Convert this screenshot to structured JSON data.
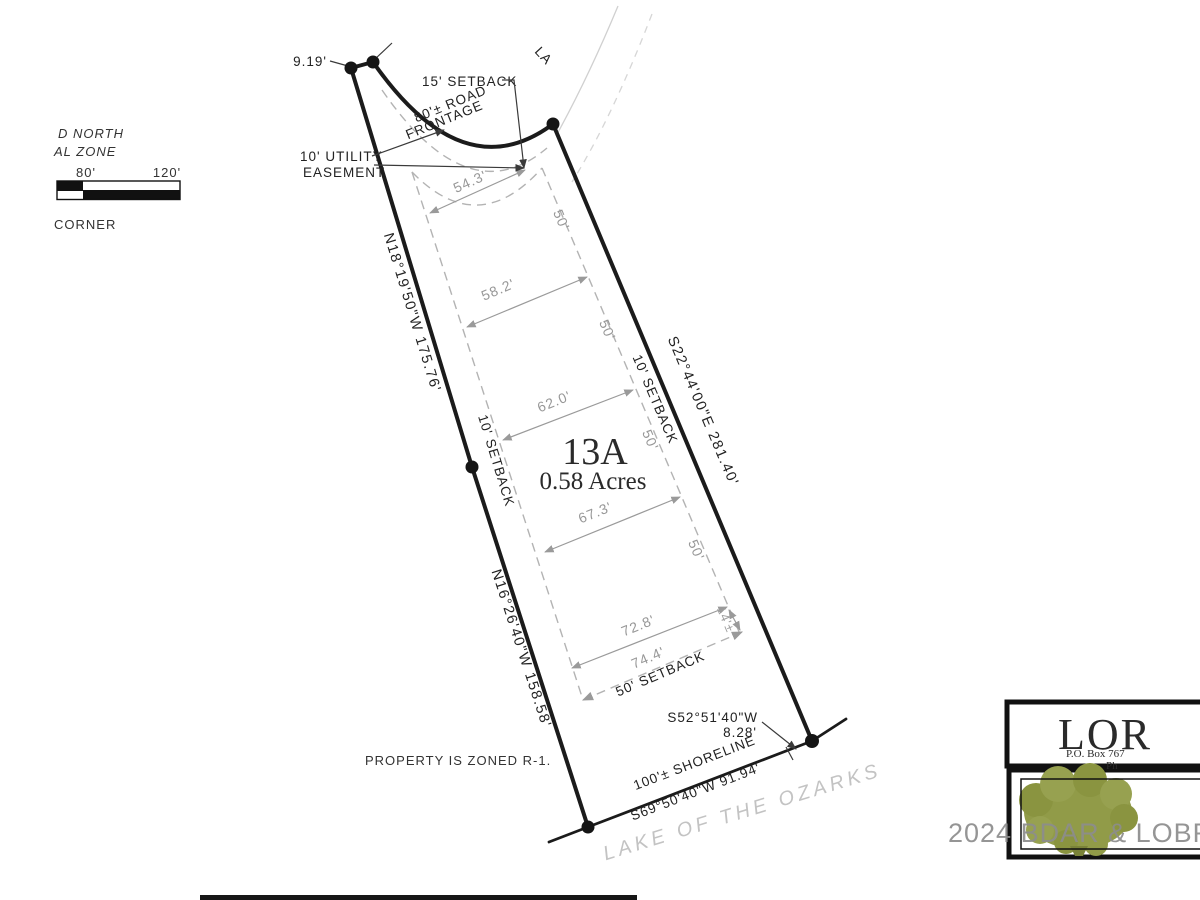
{
  "legend": {
    "north": "D NORTH",
    "zone": "AL ZONE",
    "scale_mid": "80'",
    "scale_end": "120'",
    "corner": "CORNER"
  },
  "top": {
    "offset_dim": "9.19'",
    "setback15": "15' SETBACK",
    "frontage1": "80'± ROAD",
    "frontage2": "FRONTAGE",
    "utility1": "10' UTILITY",
    "utility2": "EASEMENT",
    "road_name": "LA"
  },
  "boundaries": {
    "left_upper": "N18°19'50\"W  175.76'",
    "left_lower": "N16°26'40\"W  158.58'",
    "right": "S22°44'00\"E  281.40'",
    "setback_left": "10' SETBACK",
    "setback_right": "10' SETBACK"
  },
  "lot": {
    "number": "13A",
    "area": "0.58 Acres"
  },
  "envelope": {
    "w1": "54.3'",
    "w2": "58.2'",
    "w3": "62.0'",
    "w4": "67.3'",
    "w5": "72.8'",
    "w6": "74.4'",
    "s1": "50'",
    "s2": "50'",
    "s3": "50'",
    "s4": "50'",
    "short": "14'±",
    "bottom": "50' SETBACK"
  },
  "shore": {
    "bearing_sm": "S52°51'40\"W",
    "dist_sm": "8.28'",
    "shoreline": "100'± SHORELINE",
    "bearing": "S69°50'40\"W   91.94'",
    "lake": "LAKE OF THE OZARKS"
  },
  "notes": {
    "zoning": "PROPERTY IS ZONED R-1."
  },
  "logo": {
    "name": "LOR",
    "pobox": "P.O. Box 767",
    "phone": "Ph"
  },
  "watermark": "2024 BDAR & LOBR MLS"
}
